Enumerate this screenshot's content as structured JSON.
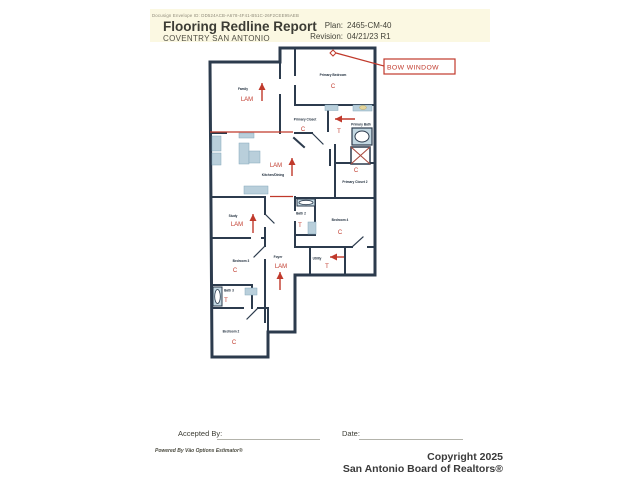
{
  "header": {
    "envelope_id": "Docusign Envelope ID: DD524ACB-A678-4F41-B51C-26F2CEE95AEB",
    "title": "Flooring Redline Report",
    "community": "COVENTRY SAN ANTONIO",
    "plan_label": "Plan:",
    "plan_number": "2465-CM-40",
    "revision_label": "Revision:",
    "revision_value": "04/21/23 R1"
  },
  "floorplan": {
    "callout_bow_window": "BOW WINDOW",
    "rooms": [
      {
        "name": "Family",
        "code": "LAM"
      },
      {
        "name": "Kitchen/Dining",
        "code": "LAM"
      },
      {
        "name": "Study",
        "code": "LAM"
      },
      {
        "name": "Foyer",
        "code": "LAM"
      },
      {
        "name": "Primary Bedroom",
        "code": "C"
      },
      {
        "name": "Primary Closet",
        "code": "C"
      },
      {
        "name": "Primary Bath",
        "code": "T"
      },
      {
        "name": "Primary Closet 2",
        "code": "C"
      },
      {
        "name": "Bath 2",
        "code": "T"
      },
      {
        "name": "Bedroom 4",
        "code": "C"
      },
      {
        "name": "Bedroom 3",
        "code": "C"
      },
      {
        "name": "Utility",
        "code": "T"
      },
      {
        "name": "Bath 3",
        "code": "T"
      },
      {
        "name": "Bedroom 2",
        "code": "C"
      }
    ]
  },
  "footer": {
    "accepted_by_label": "Accepted By:",
    "date_label": "Date:",
    "powered_by": "Powered By Väo Options Estimator®",
    "copyright_line1": "Copyright 2025",
    "copyright_line2": "San Antonio Board of Realtors®"
  },
  "colors": {
    "redline": "#c0392b",
    "wall": "#2c3b4d",
    "fixture": "#b9cfdb",
    "header_band": "#fbf8e2"
  }
}
